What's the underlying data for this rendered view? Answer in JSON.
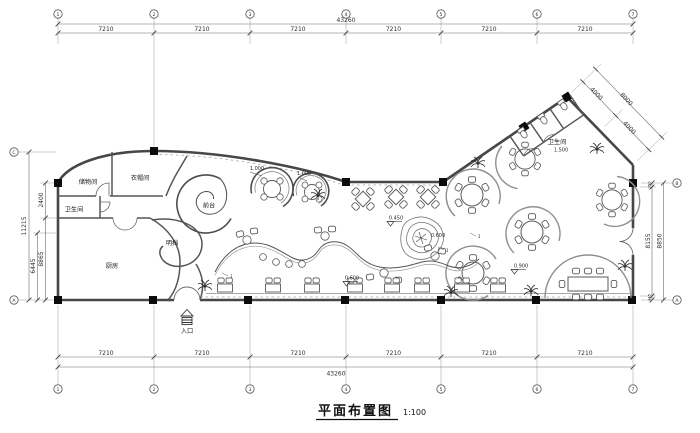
{
  "colors": {
    "background": "#ffffff",
    "line": "#3f3f3f",
    "wall": "#474747",
    "column": "#0c0c0c",
    "furniture": "#5a5a5a",
    "light_line": "#a6a6a6"
  },
  "title": {
    "text": "平面布置图",
    "scale": "1:100"
  },
  "grid": {
    "top_bubbles": [
      "1",
      "2",
      "3",
      "4",
      "5",
      "6",
      "7"
    ],
    "bottom_bubbles": [
      "1",
      "2",
      "3",
      "4",
      "5",
      "6",
      "7"
    ],
    "left_bubbles": [
      "C",
      "A"
    ],
    "right_bubbles": [
      "B",
      "A"
    ]
  },
  "dims": {
    "top": {
      "segments": [
        "7210",
        "7210",
        "7210",
        "7210",
        "7210",
        "7210"
      ],
      "total": "43260"
    },
    "bottom": {
      "segments": [
        "7210",
        "7210",
        "7210",
        "7210",
        "7210",
        "7210"
      ],
      "total": "43260"
    },
    "left": {
      "overall": "11215",
      "upper": "2400",
      "lower": "8865",
      "inner": "6445"
    },
    "right": {
      "outer": "8850",
      "inner": "8155",
      "top_small": "350",
      "bottom_small": "345"
    },
    "wing": {
      "seg1": "4000",
      "seg2": "4000",
      "total": "8000"
    }
  },
  "rooms": {
    "storage": "储物间",
    "cloakroom": "衣帽间",
    "toilet_left": "卫生间",
    "kitchen": "厨房",
    "open_kitchen": "明档",
    "front_desk": "前台",
    "toilet_right": "卫生间",
    "entrance": "入口"
  },
  "elevations": {
    "pod1": "1.000",
    "pod2": "1.000",
    "pond_left": "0.450",
    "pond_right": "0.600",
    "mid_floor": "0.600",
    "right_floor": "0.900",
    "toilet_floor": "1.500"
  },
  "annotations": {
    "marks": [
      "1",
      "1",
      "1"
    ]
  }
}
